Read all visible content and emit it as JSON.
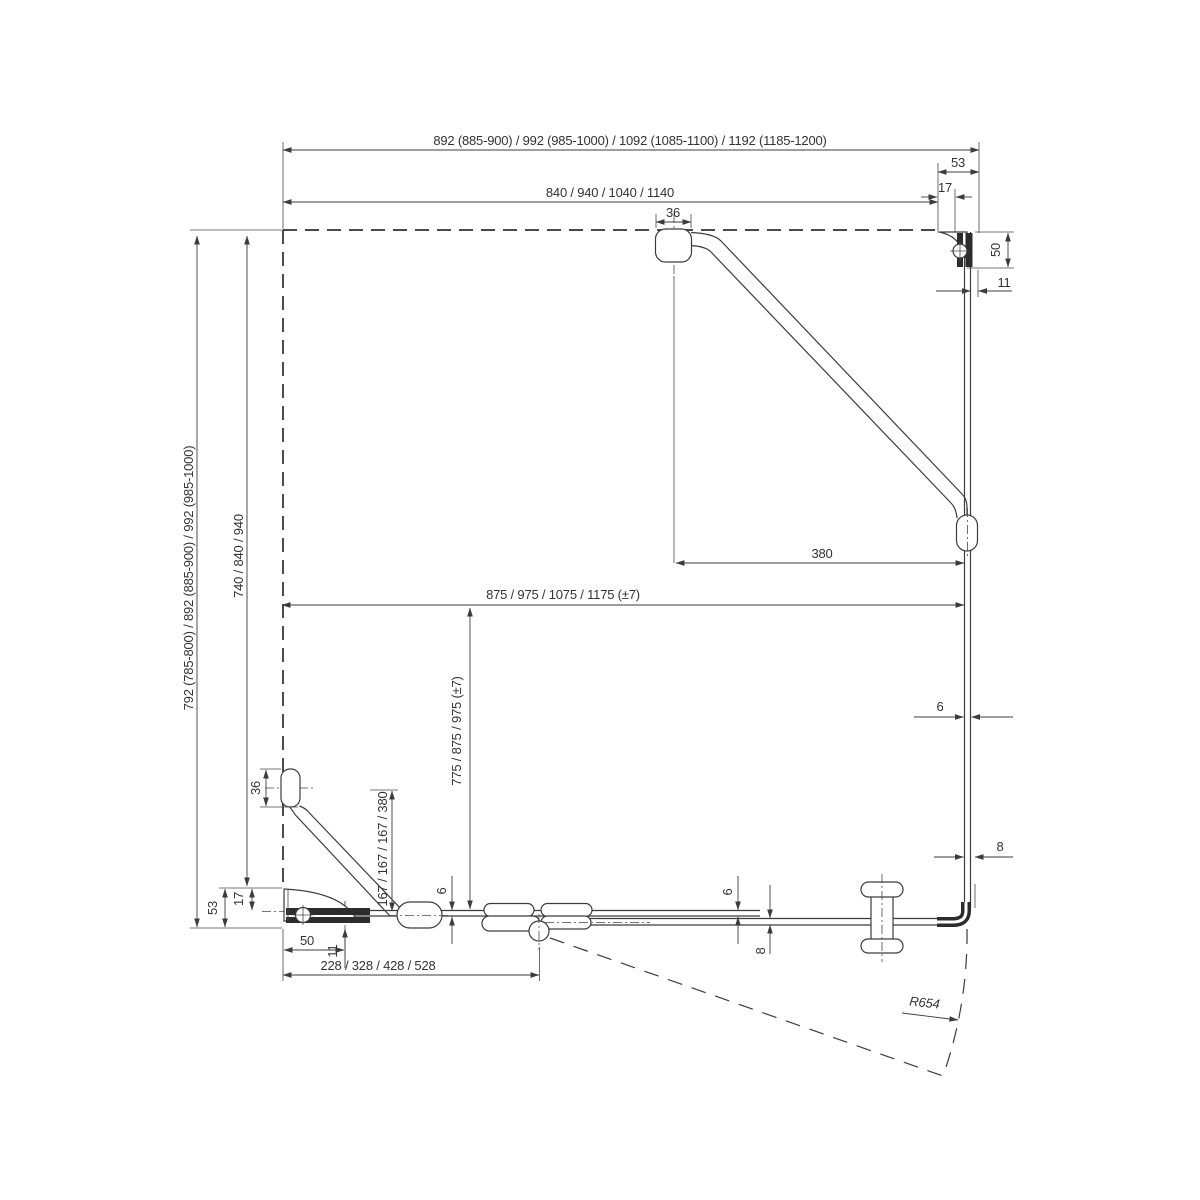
{
  "drawing": {
    "kind": "shower-enclosure-plan-technical-drawing",
    "units": "mm",
    "dimensions": {
      "top_width_overall": "892 (885-900) / 992 (985-1000) / 1092 (1085-1100) / 1192 (1185-1200)",
      "top_width_inner": "840 / 940 / 1040 / 1140",
      "top_bracket_width": "53",
      "top_bracket_inset": "17",
      "top_strut_mount": "36",
      "right_bracket_height": "50",
      "right_glass_offset": "11",
      "left_height_overall": "792 (785-800) / 892 (885-900) / 992 (985-1000)",
      "left_height_inner": "740 / 840 / 940",
      "glass_width_total": "875 / 975 / 1075 / 1175 (±7)",
      "strut_span": "380",
      "glass_depth_total": "775 / 875 / 975 (±7)",
      "left_strut_mount": "36",
      "left_strut_drop": "167 / 167 / 167 / 380",
      "bottom_bracket_height": "53",
      "bottom_bracket_inset": "17",
      "bottom_bracket_width": "50",
      "bottom_glass_offset": "11",
      "hinge_offset": "228 / 328 / 428 / 528",
      "fixed_glass_thickness_a": "6",
      "fixed_glass_thickness_b": "6",
      "door_glass_thickness": "8",
      "side_glass_thickness": "6",
      "side_door_thickness": "8",
      "door_swing_radius": "R654"
    }
  }
}
